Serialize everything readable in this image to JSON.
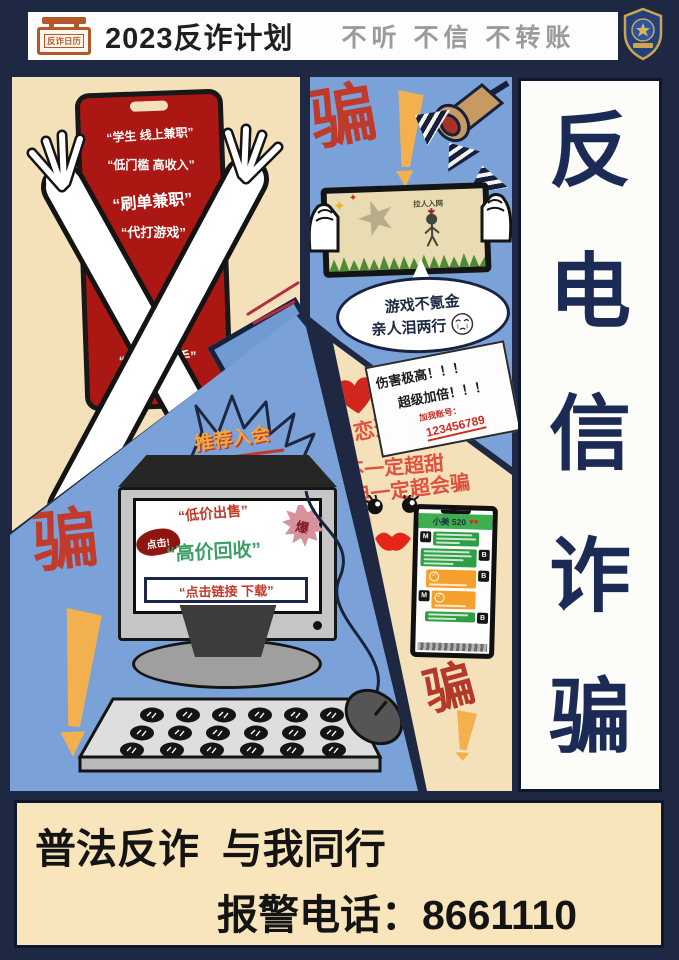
{
  "header": {
    "calendar_icon_text": "反诈日历",
    "title": "2023反诈计划",
    "slogan": "不听 不信 不转账"
  },
  "right_banner": {
    "text": "反电信诈骗",
    "chars": [
      "反",
      "电",
      "信",
      "诈",
      "骗"
    ]
  },
  "panel_parttime": {
    "phone_lines": [
      "“学生 线上兼职”",
      "“低门槛 高收入”",
      "“刷单兼职”",
      "“代打游戏”",
      "“简单易上手”"
    ]
  },
  "panel_game": {
    "scam_label": "骗",
    "screen_tag": "拉人入网",
    "bubble_line1": "游戏不氪金",
    "bubble_line2": "亲人泪两行"
  },
  "panel_romance": {
    "line1": "网恋选我",
    "line2": "不一定超甜",
    "line3": "但一定超会骗",
    "note_line1": "伤害极高！！！",
    "note_line2": "超级加倍！！！",
    "note_line3": "加我账号：",
    "note_number": "123456789"
  },
  "panel_computer": {
    "scam_label": "骗",
    "burst_text": "推荐入会",
    "click_blob": "点击!",
    "screen_line1": "“低价出售”",
    "starburst_char": "爆",
    "screen_line2": "“高价回收”",
    "screen_box": "“点击链接 下载”"
  },
  "panel_chat": {
    "contact_name": "小美 520",
    "hearts": "♥♥",
    "avatar_m": "M",
    "avatar_b": "B",
    "scam_label": "骗"
  },
  "footer": {
    "line1": "普法反诈  与我同行",
    "line2": "报警电话：8661110"
  },
  "colors": {
    "navy_bg": "#1e2843",
    "panel_cream": "#f4e1ba",
    "panel_blue": "#7aa2d8",
    "scam_red": "#bf3a2b",
    "accent_orange": "#f2b04e",
    "chat_green": "#2f9e44",
    "chat_orange": "#f59f2c"
  }
}
